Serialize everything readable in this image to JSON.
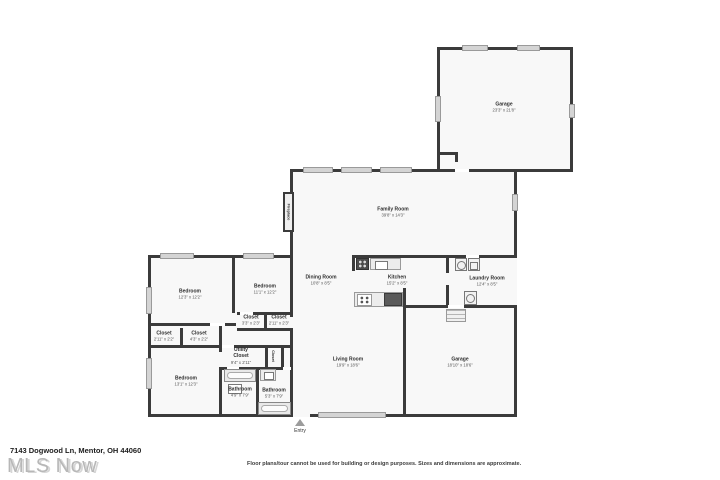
{
  "page": {
    "address": "7143 Dogwood Ln, Mentor, OH 44060",
    "watermark": "MLS Now",
    "disclaimer": "Floor plans/tour cannot be used for building or design purposes. Sizes and dimensions are approximate.",
    "entry_label": "Entry"
  },
  "colors": {
    "wall": "#3b3b3b",
    "window": "#d4d4d4",
    "room_fill": "#f8f8f8",
    "label_text": "#2e2e2e",
    "watermark_gray": "#b0b0b0"
  },
  "rooms": [
    {
      "id": "garage-top",
      "name": "Garage",
      "dims": "23'3\" x 21'8\""
    },
    {
      "id": "family-room",
      "name": "Family Room",
      "dims": "39'8\" x 14'3\""
    },
    {
      "id": "dining-room",
      "name": "Dining Room",
      "dims": "10'8\" x 8'5\""
    },
    {
      "id": "kitchen",
      "name": "Kitchen",
      "dims": "15'2\" x 8'5\""
    },
    {
      "id": "laundry-room",
      "name": "Laundry Room",
      "dims": "12'4\" x 8'5\""
    },
    {
      "id": "bedroom-1",
      "name": "Bedroom",
      "dims": "12'3\" x 12'2\""
    },
    {
      "id": "bedroom-2",
      "name": "Bedroom",
      "dims": "11'1\" x 12'2\""
    },
    {
      "id": "closet-1",
      "name": "Closet",
      "dims": "3'3\" x 2'3\""
    },
    {
      "id": "closet-2",
      "name": "Closet",
      "dims": "2'11\" x 2'3\""
    },
    {
      "id": "closet-3",
      "name": "Closet",
      "dims": "2'11\" x 2'2\""
    },
    {
      "id": "closet-4",
      "name": "Closet",
      "dims": "4'3\" x 2'2\""
    },
    {
      "id": "bedroom-3",
      "name": "Bedroom",
      "dims": "13'1\" x 12'3\""
    },
    {
      "id": "utility-closet",
      "name": "Utility Closet",
      "dims": "9'4\" x 2'11\""
    },
    {
      "id": "closet-vertical",
      "name": "Closet",
      "dims": ""
    },
    {
      "id": "bathroom-1",
      "name": "Bathroom",
      "dims": "4'9\" x 7'9\""
    },
    {
      "id": "bathroom-2",
      "name": "Bathroom",
      "dims": "5'3\" x 7'9\""
    },
    {
      "id": "living-room",
      "name": "Living Room",
      "dims": "19'9\" x 18'6\""
    },
    {
      "id": "garage-bottom",
      "name": "Garage",
      "dims": "18'10\" x 18'6\""
    },
    {
      "id": "fireplace",
      "name": "Fireplace",
      "dims": ""
    }
  ]
}
